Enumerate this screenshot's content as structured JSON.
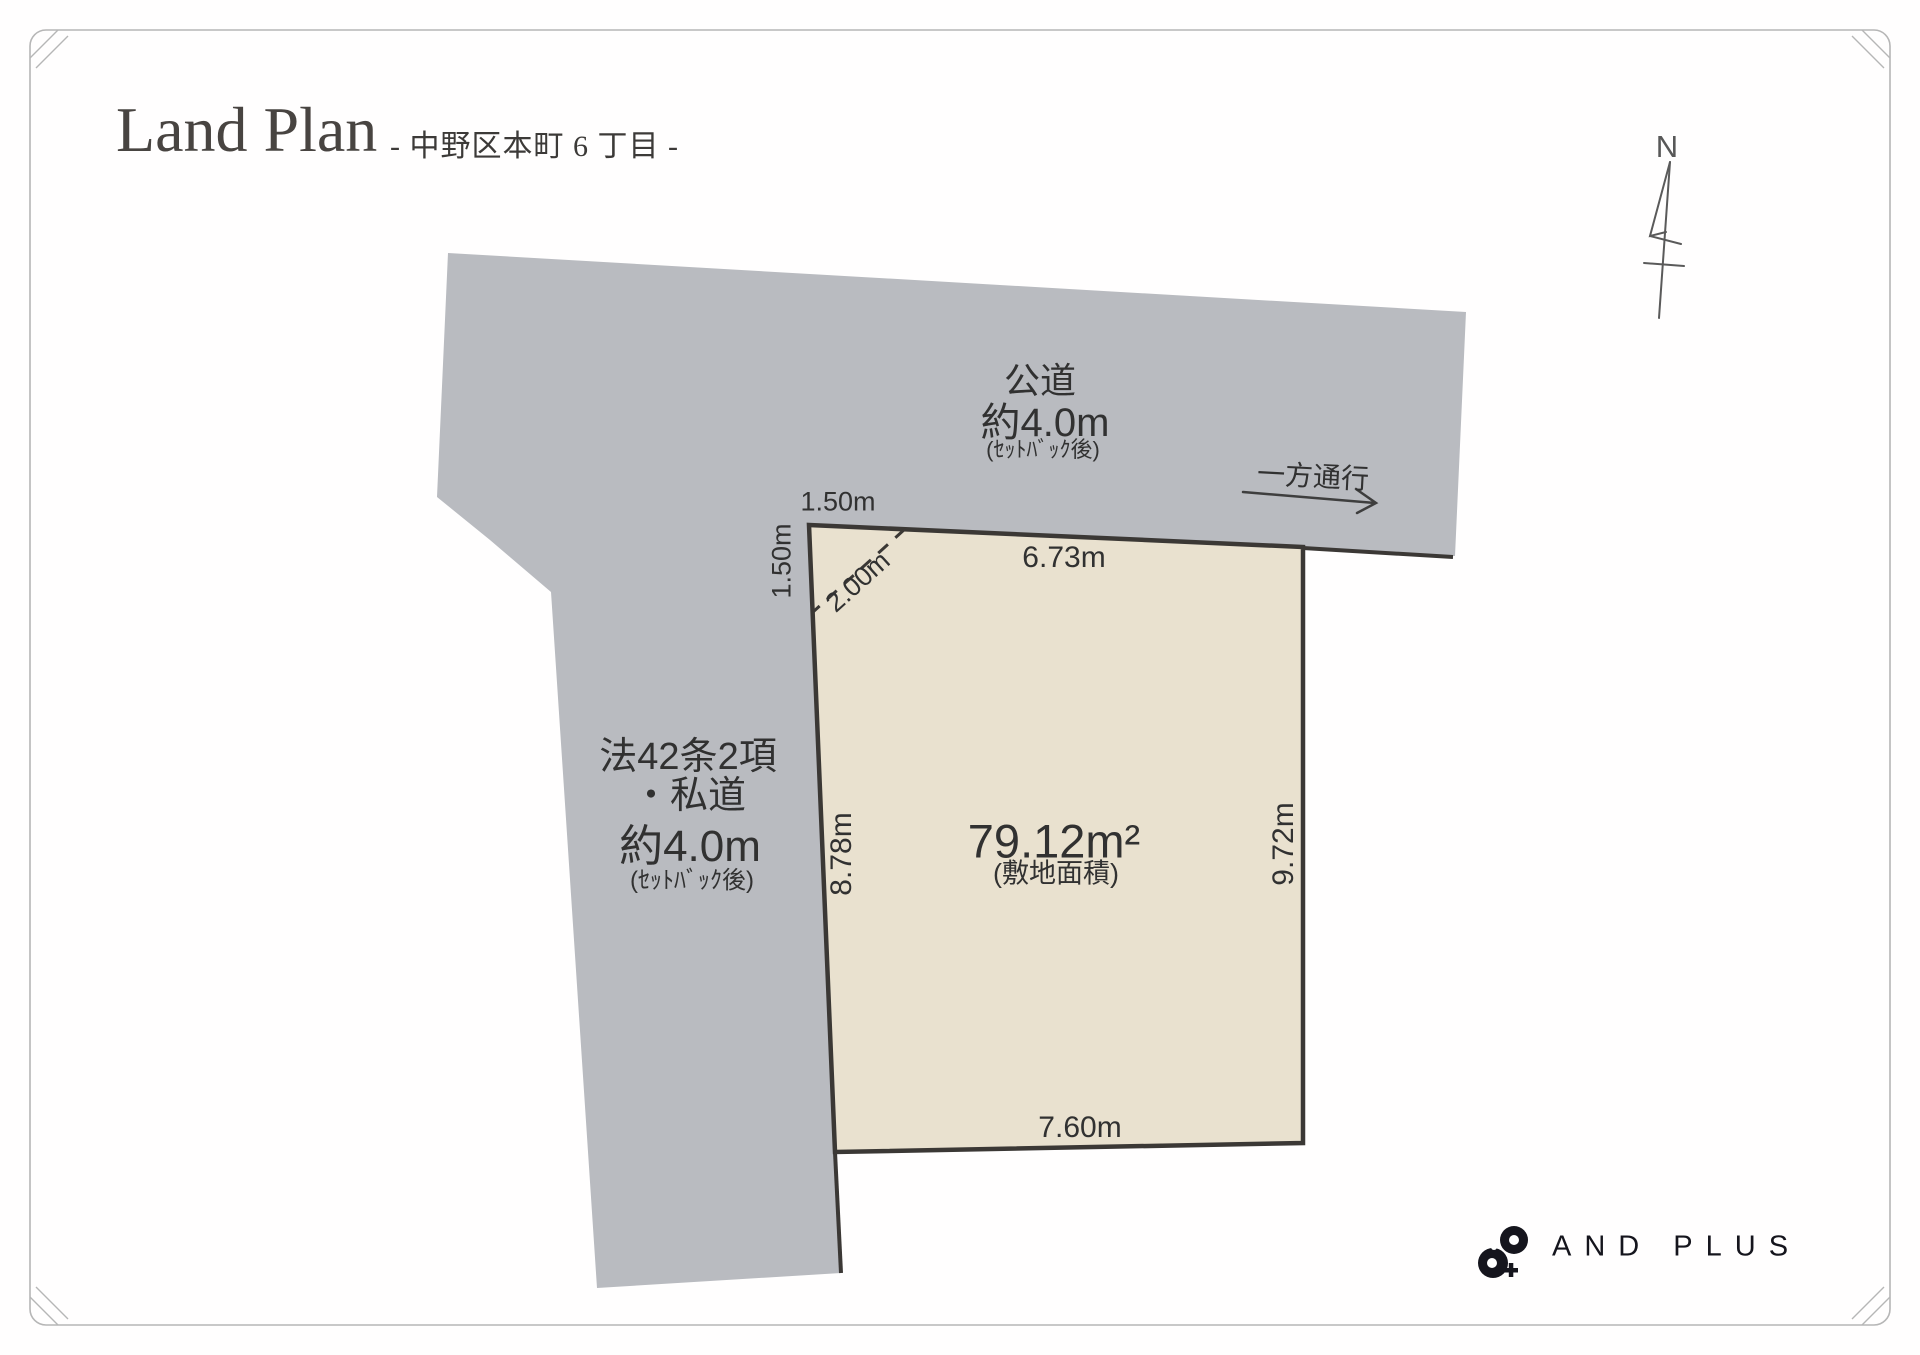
{
  "header": {
    "title": "Land Plan",
    "subtitle": "- 中野区本町 6 丁目 -"
  },
  "compass": {
    "north_label": "N"
  },
  "public_road": {
    "name": "公道",
    "width": "約4.0m",
    "note": "(ｾｯﾄﾊﾞｯｸ後)",
    "one_way": "一方通行"
  },
  "private_road": {
    "law": "法42条2項",
    "name": "・私道",
    "width": "約4.0m",
    "note": "(ｾｯﾄﾊﾞｯｸ後)"
  },
  "site": {
    "area": "79.12m²",
    "area_note": "(敷地面積)",
    "edge_top": "6.73m",
    "edge_left": "8.78m",
    "edge_right": "9.72m",
    "edge_bottom": "7.60m",
    "setback_top": "1.50m",
    "setback_side": "1.50m",
    "setback_diagonal": "2.00m"
  },
  "brand": {
    "name": "AND PLUS"
  },
  "colors": {
    "road_fill": "#b9bbc0",
    "land_fill": "#e9e1cf",
    "outline": "#3b3835",
    "line": "#3e3e3e",
    "compass": "#5a5a5a",
    "frame": "#b6b6b6",
    "brand": "#15151d"
  }
}
